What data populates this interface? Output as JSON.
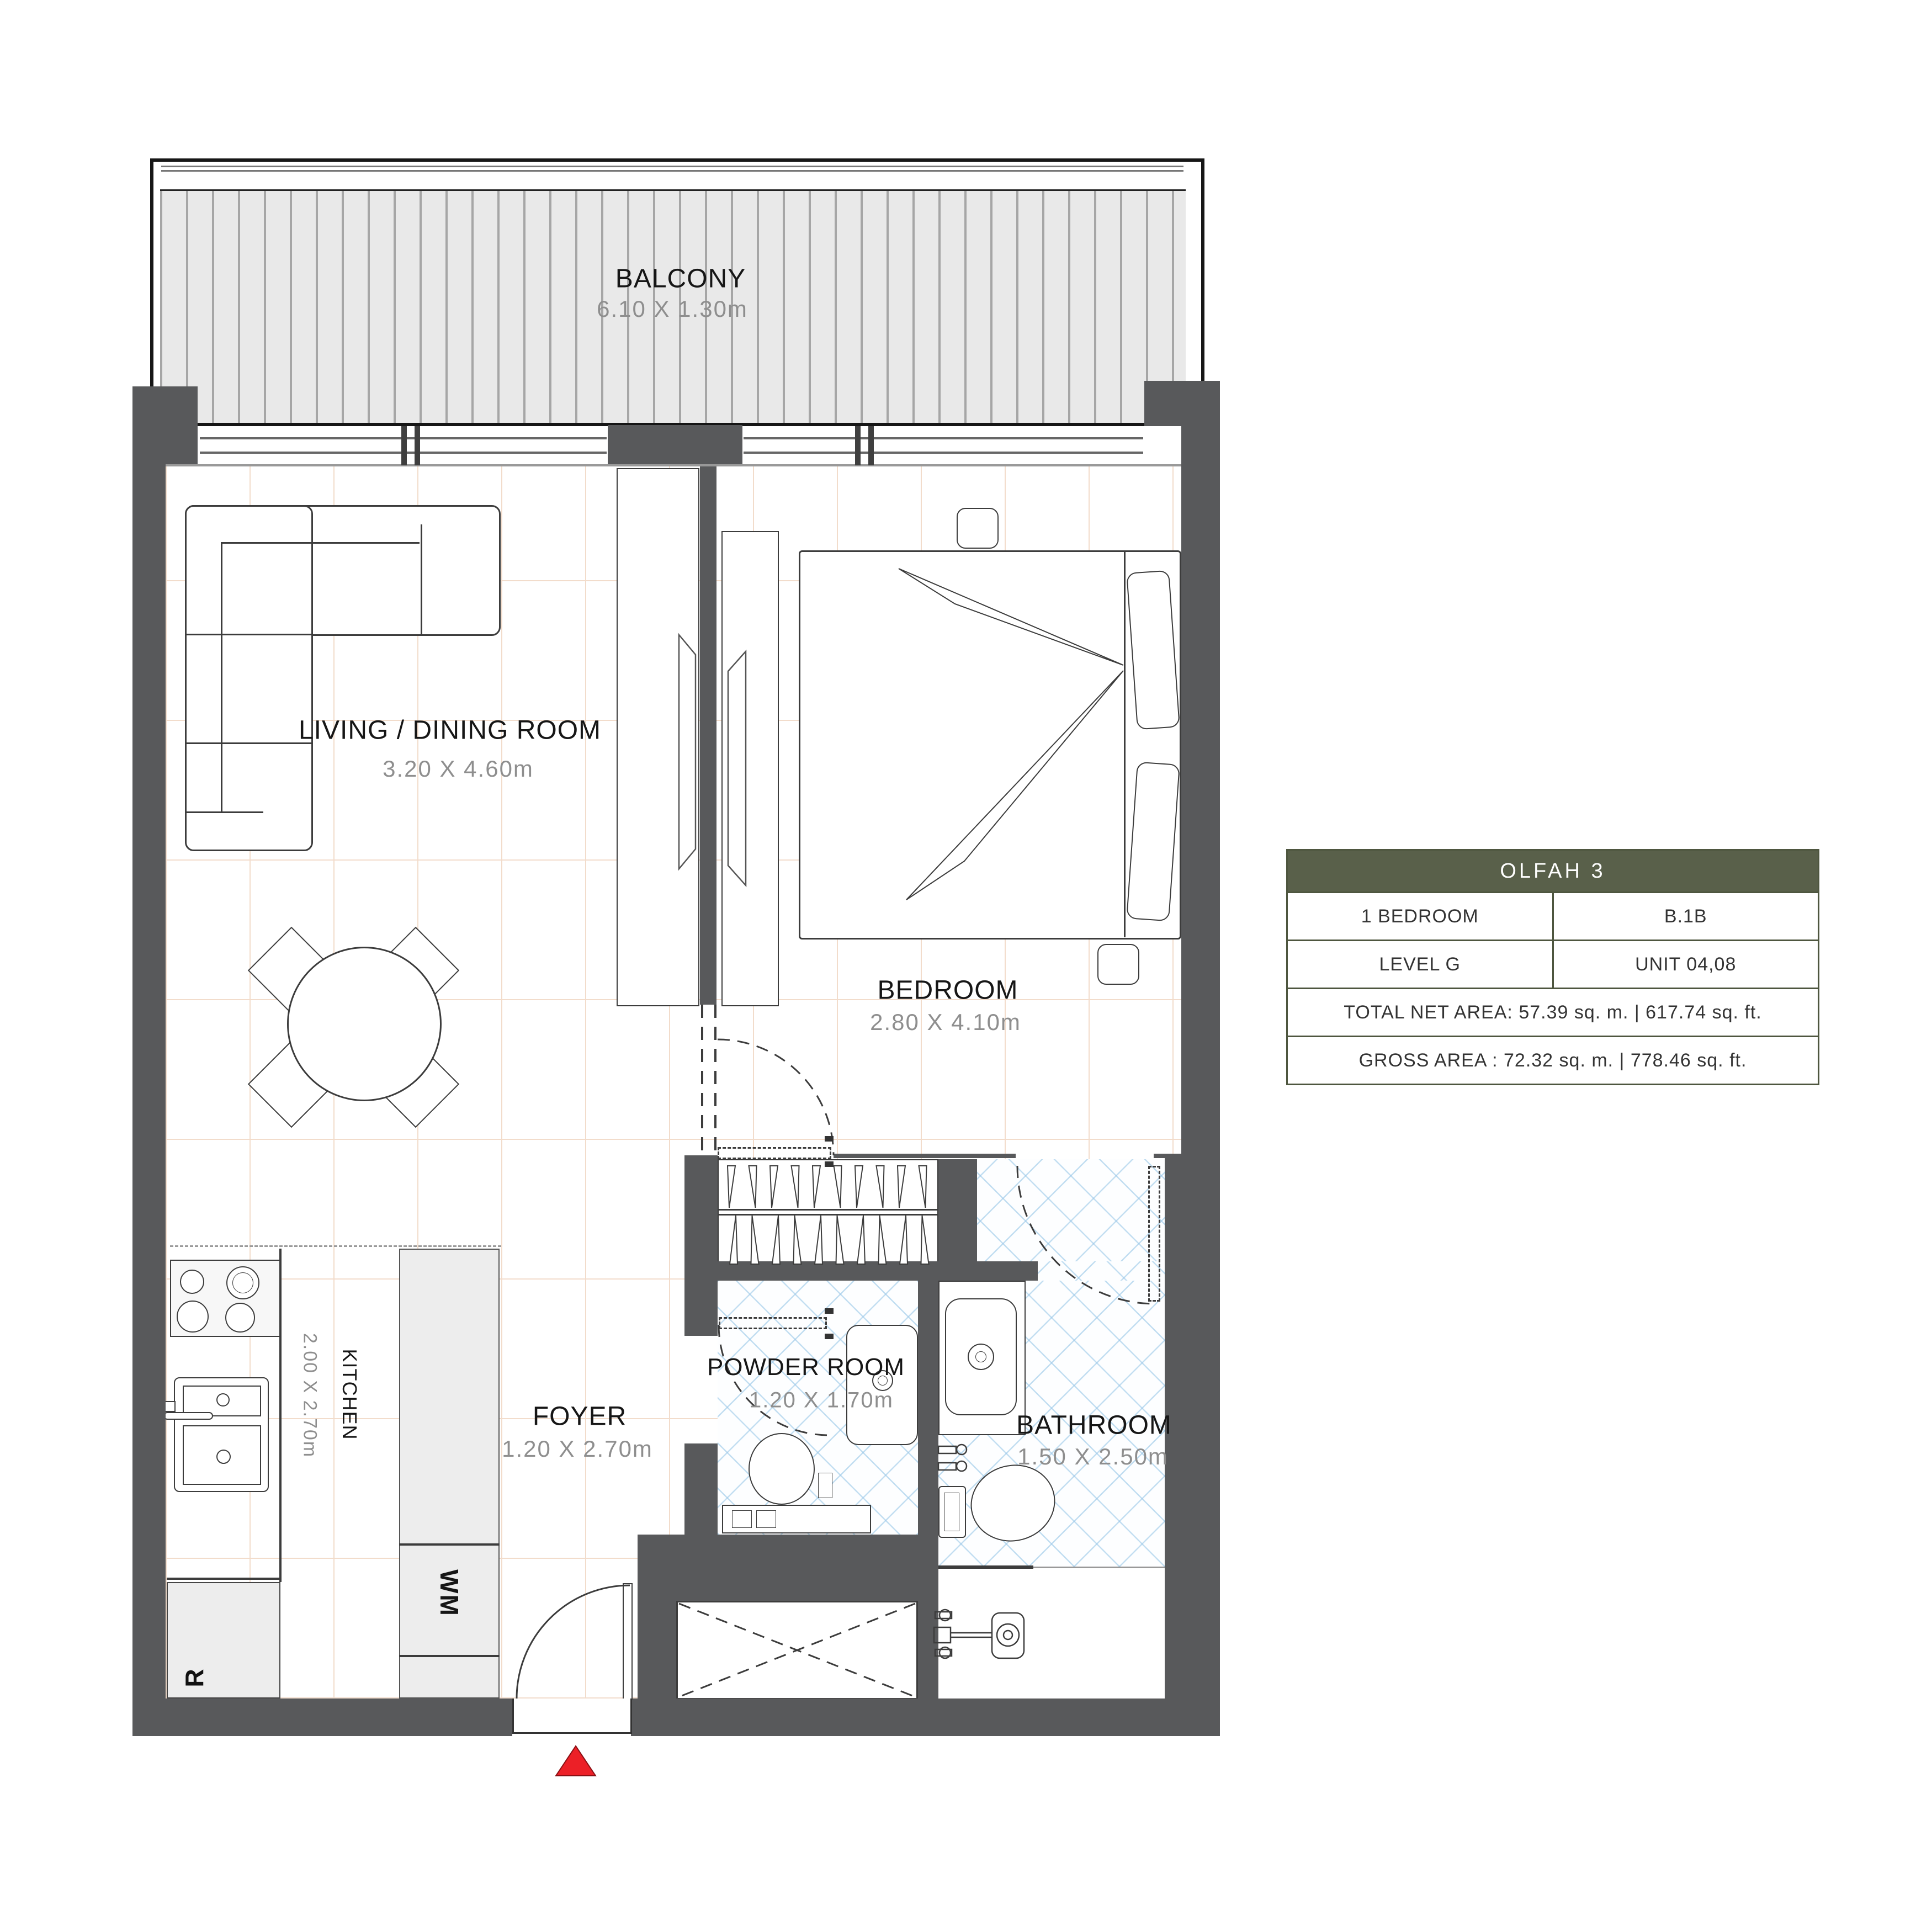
{
  "plan": {
    "type": "apartment-floor-plan"
  },
  "rooms": {
    "balcony": {
      "name": "BALCONY",
      "dims": "6.10 X 1.30m"
    },
    "living_dining": {
      "name": "LIVING / DINING ROOM",
      "dims": "3.20 X 4.60m"
    },
    "bedroom": {
      "name": "BEDROOM",
      "dims": "2.80 X 4.10m"
    },
    "kitchen": {
      "name": "KITCHEN",
      "dims": "2.00 X 2.70m"
    },
    "foyer": {
      "name": "FOYER",
      "dims": "1.20 X 2.70m"
    },
    "powder_room": {
      "name": "POWDER ROOM",
      "dims": "1.20 X 1.70m"
    },
    "bathroom": {
      "name": "BATHROOM",
      "dims": "1.50 X 2.50m"
    }
  },
  "appliances": {
    "washing_machine": "WM",
    "refrigerator": "R"
  },
  "info_table": {
    "header": "OLFAH 3",
    "rows": [
      {
        "left": "1 BEDROOM",
        "right": "B.1B"
      },
      {
        "left": "LEVEL G",
        "right": "UNIT 04,08"
      }
    ],
    "area_rows": [
      "TOTAL NET AREA: 57.39 sq. m. | 617.74 sq. ft.",
      "GROSS AREA : 72.32 sq. m. | 778.46 sq. ft."
    ]
  },
  "colors": {
    "accent_olive": "#59604a",
    "wall_gray": "#58595b",
    "entrance_marker_red": "#ec2027",
    "hatch_blue": "#cfe3f2",
    "tile_line": "#f2dccb"
  }
}
